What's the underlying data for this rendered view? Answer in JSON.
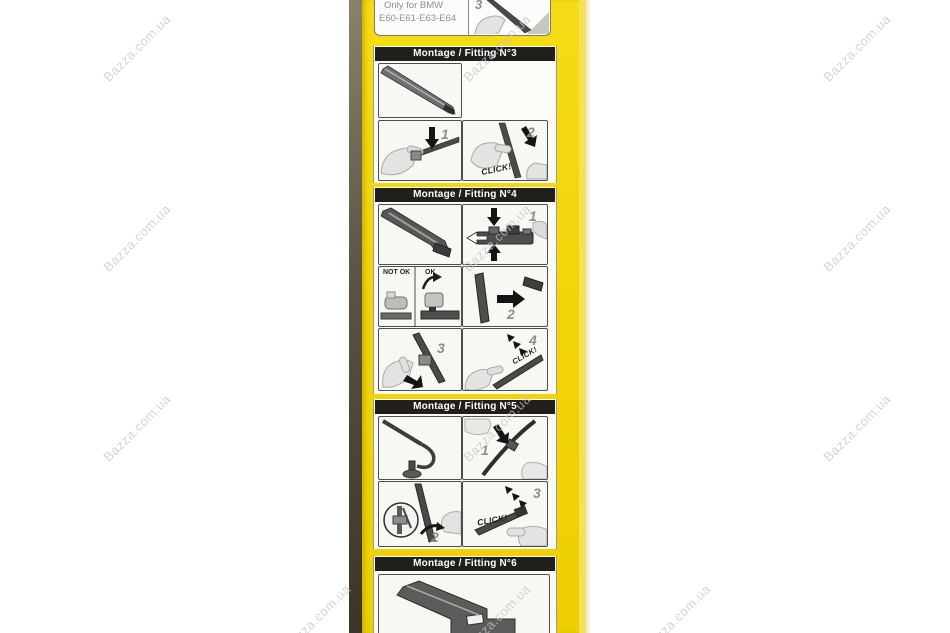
{
  "watermark": {
    "text": "Bazza.com.ua"
  },
  "colors": {
    "background": "#ffffff",
    "box_yellow": "#f2d40a",
    "box_edge_dark": "#4a4234",
    "box_edge_light": "#f3e158",
    "header_bg": "#201f1d",
    "header_text": "#ffffff",
    "panel_bg": "#f7f7f4",
    "panel_border": "#4e4e48",
    "watermark": "#c6c6c6",
    "label_gray": "#8e8e8e"
  },
  "top_panel": {
    "line1": "Only for BMW",
    "line2": "E60-E61-E63-E64",
    "step": "3"
  },
  "sections": [
    {
      "id": "fitting3",
      "title": "Montage / Fitting N°3",
      "labels": {
        "step1": "1",
        "step2": "2",
        "click": "CLICK!"
      }
    },
    {
      "id": "fitting4",
      "title": "Montage / Fitting N°4",
      "labels": {
        "not_ok": "NOT OK",
        "ok": "OK",
        "step1": "1",
        "step2": "2",
        "step3": "3",
        "step4": "4",
        "click": "CLICK!"
      }
    },
    {
      "id": "fitting5",
      "title": "Montage / Fitting N°5",
      "labels": {
        "step1": "1",
        "step2": "2",
        "step3": "3",
        "click": "CLICK!"
      }
    },
    {
      "id": "fitting6",
      "title": "Montage / Fitting N°6"
    }
  ]
}
